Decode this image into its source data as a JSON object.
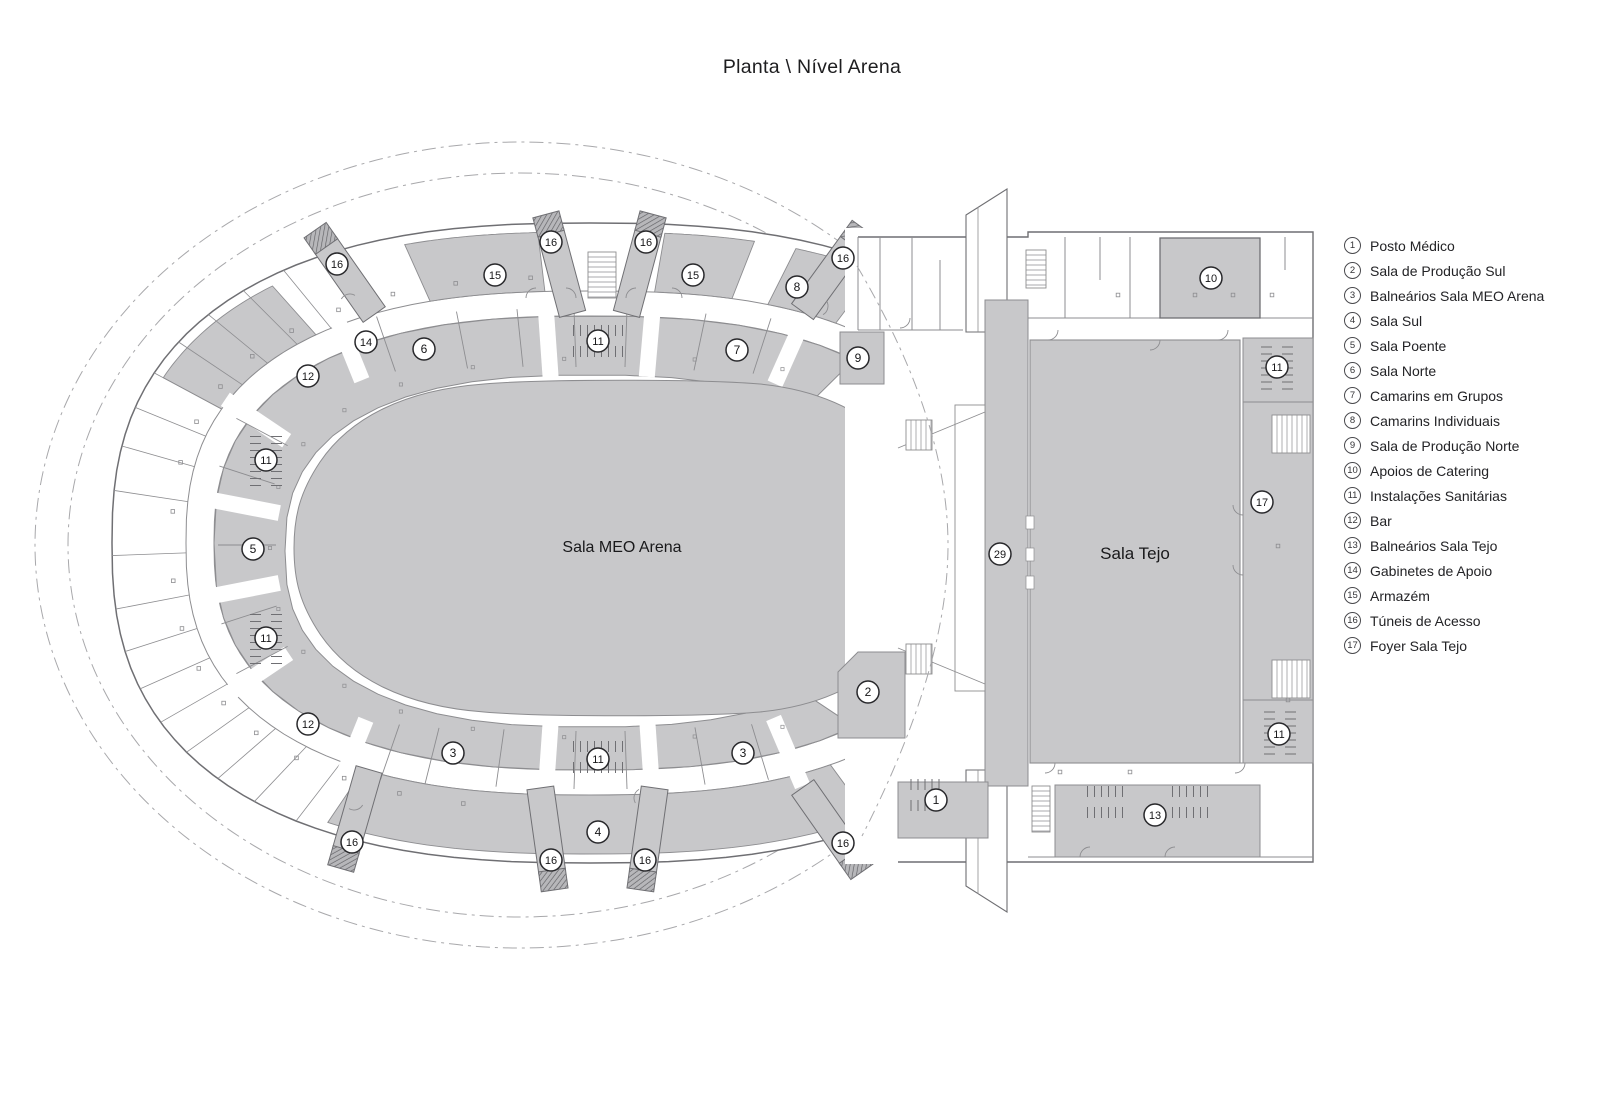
{
  "title": "Planta \\ Nível Arena",
  "plan": {
    "labels": [
      {
        "name": "sala-meo-arena-label",
        "text": "Sala MEO Arena",
        "x": 622,
        "y": 552,
        "size": 16
      },
      {
        "name": "sala-tejo-label",
        "text": "Sala Tejo",
        "x": 1135,
        "y": 559,
        "size": 17
      }
    ],
    "markers": [
      {
        "n": "1",
        "x": 936,
        "y": 800
      },
      {
        "n": "2",
        "x": 868,
        "y": 692
      },
      {
        "n": "3",
        "x": 453,
        "y": 753
      },
      {
        "n": "3",
        "x": 743,
        "y": 753
      },
      {
        "n": "4",
        "x": 598,
        "y": 832
      },
      {
        "n": "5",
        "x": 253,
        "y": 549
      },
      {
        "n": "6",
        "x": 424,
        "y": 349
      },
      {
        "n": "7",
        "x": 737,
        "y": 350
      },
      {
        "n": "8",
        "x": 797,
        "y": 287
      },
      {
        "n": "9",
        "x": 858,
        "y": 358
      },
      {
        "n": "10",
        "x": 1211,
        "y": 278
      },
      {
        "n": "11",
        "x": 598,
        "y": 341
      },
      {
        "n": "11",
        "x": 266,
        "y": 460
      },
      {
        "n": "11",
        "x": 266,
        "y": 638
      },
      {
        "n": "11",
        "x": 598,
        "y": 759
      },
      {
        "n": "11",
        "x": 1277,
        "y": 367
      },
      {
        "n": "11",
        "x": 1279,
        "y": 734
      },
      {
        "n": "12",
        "x": 308,
        "y": 376
      },
      {
        "n": "12",
        "x": 308,
        "y": 724
      },
      {
        "n": "13",
        "x": 1155,
        "y": 815
      },
      {
        "n": "14",
        "x": 366,
        "y": 342
      },
      {
        "n": "15",
        "x": 495,
        "y": 275
      },
      {
        "n": "15",
        "x": 693,
        "y": 275
      },
      {
        "n": "16",
        "x": 337,
        "y": 264
      },
      {
        "n": "16",
        "x": 551,
        "y": 242
      },
      {
        "n": "16",
        "x": 646,
        "y": 242
      },
      {
        "n": "16",
        "x": 843,
        "y": 258
      },
      {
        "n": "16",
        "x": 352,
        "y": 842
      },
      {
        "n": "16",
        "x": 551,
        "y": 860
      },
      {
        "n": "16",
        "x": 645,
        "y": 860
      },
      {
        "n": "16",
        "x": 843,
        "y": 843
      },
      {
        "n": "17",
        "x": 1262,
        "y": 502
      },
      {
        "n": "29",
        "x": 1000,
        "y": 554
      }
    ],
    "colors": {
      "room_fill": "#c8c8ca",
      "wall": "#8d8d90",
      "wall_dark": "#6f6f73",
      "hatch": "#5f5f63",
      "dash": "#a8a8ab",
      "ink": "#19191b"
    }
  },
  "legend": {
    "items": [
      {
        "num": "1",
        "label": "Posto Médico"
      },
      {
        "num": "2",
        "label": "Sala de Produção Sul"
      },
      {
        "num": "3",
        "label": "Balneários Sala MEO Arena"
      },
      {
        "num": "4",
        "label": "Sala Sul"
      },
      {
        "num": "5",
        "label": "Sala Poente"
      },
      {
        "num": "6",
        "label": "Sala Norte"
      },
      {
        "num": "7",
        "label": "Camarins em Grupos"
      },
      {
        "num": "8",
        "label": "Camarins Individuais"
      },
      {
        "num": "9",
        "label": "Sala de Produção Norte"
      },
      {
        "num": "10",
        "label": "Apoios de Catering"
      },
      {
        "num": "11",
        "label": "Instalações Sanitárias"
      },
      {
        "num": "12",
        "label": "Bar"
      },
      {
        "num": "13",
        "label": "Balneários Sala Tejo"
      },
      {
        "num": "14",
        "label": "Gabinetes de Apoio"
      },
      {
        "num": "15",
        "label": "Armazém"
      },
      {
        "num": "16",
        "label": "Túneis de Acesso"
      },
      {
        "num": "17",
        "label": "Foyer Sala Tejo"
      }
    ]
  }
}
